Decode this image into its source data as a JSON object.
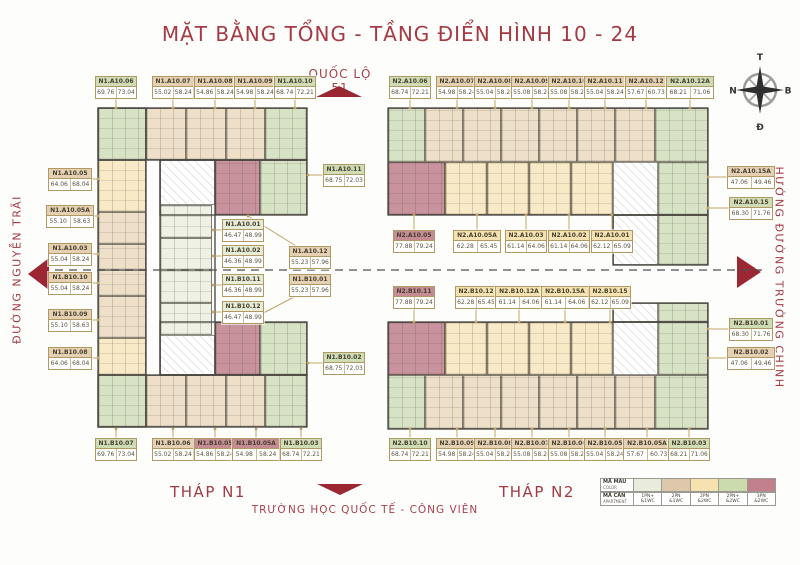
{
  "title": "MẶT BẰNG TỔNG - TẦNG ĐIỂN HÌNH 10 - 24",
  "roads": {
    "top": "QUỐC LỘ 51",
    "left": "ĐƯỜNG NGUYỄN TRÃI",
    "right": "HƯỚNG ĐƯỜNG TRƯỜNG CHINH",
    "bottom": "TRƯỜNG HỌC QUỐC TẾ - CÔNG VIÊN"
  },
  "towers": {
    "n1": "THÁP N1",
    "n2": "THÁP N2"
  },
  "compass": {
    "top": "T",
    "left": "N",
    "right": "B",
    "bottom": "Đ"
  },
  "legend": {
    "row1_label": "MÃ MÀU",
    "row1_sub": "COLOR",
    "row2_label": "MÃ CĂN",
    "row2_sub": "APARTMENT",
    "types": [
      {
        "code": "1PN+",
        "wc": "&1WC",
        "color": "#e9ecdc",
        "key": "celadon"
      },
      {
        "code": "2PN",
        "wc": "&1WC",
        "color": "#ddc8ab",
        "key": "tan"
      },
      {
        "code": "2PN",
        "wc": "&2WC",
        "color": "#f6e2ae",
        "key": "yellow"
      },
      {
        "code": "2PN+",
        "wc": "&2WC",
        "color": "#cbdbae",
        "key": "green"
      },
      {
        "code": "3PN",
        "wc": "&2WC",
        "color": "#c2808d",
        "key": "pink"
      }
    ]
  },
  "accent_red": "#a43a44",
  "arrow_red": "#9b2733",
  "units": [
    {
      "name": "N1.A10.06",
      "a1": "69.76",
      "a2": "73.04",
      "type": "green",
      "x": 95,
      "y": 76,
      "dir": "down"
    },
    {
      "name": "N1.A10.07",
      "a1": "55.02",
      "a2": "58.24",
      "type": "tan",
      "x": 152,
      "y": 76,
      "dir": "down"
    },
    {
      "name": "N1.A10.08",
      "a1": "54.86",
      "a2": "58.24",
      "type": "tan",
      "x": 194,
      "y": 76,
      "dir": "down"
    },
    {
      "name": "N1.A10.09",
      "a1": "54.98",
      "a2": "58.24",
      "type": "tan",
      "x": 234,
      "y": 76,
      "dir": "down"
    },
    {
      "name": "N1.A10.10",
      "a1": "68.74",
      "a2": "72.21",
      "type": "green",
      "x": 274,
      "y": 76,
      "dir": "down"
    },
    {
      "name": "N2.A10.06",
      "a1": "68.74",
      "a2": "72.21",
      "type": "green",
      "x": 389,
      "y": 76,
      "dir": "down"
    },
    {
      "name": "N2.A10.07",
      "a1": "54.98",
      "a2": "58.24",
      "type": "tan",
      "x": 436,
      "y": 76,
      "dir": "down"
    },
    {
      "name": "N2.A10.08",
      "a1": "55.04",
      "a2": "58.24",
      "type": "tan",
      "x": 474,
      "y": 76,
      "dir": "down"
    },
    {
      "name": "N2.A10.09",
      "a1": "55.08",
      "a2": "58.24",
      "type": "tan",
      "x": 511,
      "y": 76,
      "dir": "down"
    },
    {
      "name": "N2.A10.10",
      "a1": "55.08",
      "a2": "58.24",
      "type": "tan",
      "x": 548,
      "y": 76,
      "dir": "down"
    },
    {
      "name": "N2.A10.11",
      "a1": "55.04",
      "a2": "58.24",
      "type": "tan",
      "x": 584,
      "y": 76,
      "dir": "down"
    },
    {
      "name": "N2.A10.12",
      "a1": "57.67",
      "a2": "60.73",
      "type": "tan",
      "x": 625,
      "y": 76,
      "dir": "down"
    },
    {
      "name": "N2.A10.12A",
      "a1": "68.21",
      "a2": "71.06",
      "type": "green",
      "x": 666,
      "y": 76,
      "w": 48,
      "dir": "down"
    },
    {
      "name": "N1.A10.05",
      "a1": "64.06",
      "a2": "68.04",
      "type": "tan",
      "x": 48,
      "y": 168,
      "w": 44,
      "dir": "right"
    },
    {
      "name": "N1.A10.05A",
      "a1": "55.10",
      "a2": "58.63",
      "type": "tan",
      "x": 46,
      "y": 205,
      "w": 48,
      "dir": "right"
    },
    {
      "name": "N1.A10.03",
      "a1": "55.04",
      "a2": "58.24",
      "type": "tan",
      "x": 48,
      "y": 243,
      "w": 44,
      "dir": "right"
    },
    {
      "name": "N1.B10.10",
      "a1": "55.04",
      "a2": "58.24",
      "type": "tan",
      "x": 48,
      "y": 272,
      "w": 44,
      "dir": "right"
    },
    {
      "name": "N1.B10.09",
      "a1": "55.10",
      "a2": "58.63",
      "type": "tan",
      "x": 48,
      "y": 309,
      "w": 44,
      "dir": "right"
    },
    {
      "name": "N1.B10.08",
      "a1": "64.06",
      "a2": "68.04",
      "type": "tan",
      "x": 48,
      "y": 347,
      "w": 44,
      "dir": "right"
    },
    {
      "name": "N1.A10.11",
      "a1": "68.75",
      "a2": "72.03",
      "type": "green",
      "x": 323,
      "y": 164,
      "leader": [
        323,
        175,
        308,
        175
      ]
    },
    {
      "name": "N1.A10.01",
      "a1": "46.47",
      "a2": "48.99",
      "type": "celadon",
      "x": 222,
      "y": 219,
      "leader": [
        222,
        230,
        213,
        230
      ]
    },
    {
      "name": "N1.A10.02",
      "a1": "46.36",
      "a2": "48.99",
      "type": "celadon",
      "x": 222,
      "y": 245,
      "leader": [
        222,
        256,
        213,
        256
      ]
    },
    {
      "name": "N1.A10.12",
      "a1": "55.23",
      "a2": "57.96",
      "type": "tan",
      "x": 289,
      "y": 246,
      "leader": [
        296,
        246,
        248,
        216
      ]
    },
    {
      "name": "N1.B10.11",
      "a1": "46.36",
      "a2": "48.99",
      "type": "celadon",
      "x": 222,
      "y": 274,
      "leader": [
        222,
        285,
        213,
        285
      ]
    },
    {
      "name": "N1.B10.01",
      "a1": "55.23",
      "a2": "57.96",
      "type": "tan",
      "x": 289,
      "y": 274,
      "leader": [
        296,
        296,
        248,
        321
      ]
    },
    {
      "name": "N1.B10.12",
      "a1": "46.47",
      "a2": "48.99",
      "type": "celadon",
      "x": 222,
      "y": 301,
      "leader": [
        222,
        312,
        213,
        312
      ]
    },
    {
      "name": "N1.B10.02",
      "a1": "68.75",
      "a2": "72.03",
      "type": "green",
      "x": 323,
      "y": 352,
      "leader": [
        323,
        363,
        308,
        363
      ]
    },
    {
      "name": "N2.A10.05",
      "a1": "77.88",
      "a2": "79.24",
      "type": "pink",
      "x": 393,
      "y": 230,
      "dir": "up-short"
    },
    {
      "name": "N2.A10.05A",
      "a1": "62.28",
      "a2": "65.45",
      "type": "yellow",
      "x": 453,
      "y": 230,
      "w": 48,
      "dir": "up-short"
    },
    {
      "name": "N2.A10.03",
      "a1": "61.14",
      "a2": "64.06",
      "type": "yellow",
      "x": 505,
      "y": 230,
      "dir": "up-short"
    },
    {
      "name": "N2.A10.02",
      "a1": "61.14",
      "a2": "64.06",
      "type": "yellow",
      "x": 548,
      "y": 230,
      "dir": "up-short"
    },
    {
      "name": "N2.A10.01",
      "a1": "62.12",
      "a2": "65.09",
      "type": "yellow",
      "x": 591,
      "y": 230,
      "dir": "up-short"
    },
    {
      "name": "N2.B10.11",
      "a1": "77.88",
      "a2": "79.24",
      "type": "pink",
      "x": 393,
      "y": 286,
      "dir": "down-short"
    },
    {
      "name": "N2.B10.12",
      "a1": "62.28",
      "a2": "65.45",
      "type": "yellow",
      "x": 455,
      "y": 286,
      "dir": "down-short"
    },
    {
      "name": "N2.B10.12A",
      "a1": "61.14",
      "a2": "64.06",
      "type": "yellow",
      "x": 495,
      "y": 286,
      "w": 48,
      "dir": "down-short"
    },
    {
      "name": "N2.B10.15A",
      "a1": "61.14",
      "a2": "64.06",
      "type": "yellow",
      "x": 541,
      "y": 286,
      "w": 48,
      "dir": "down-short"
    },
    {
      "name": "N2.B10.15",
      "a1": "62.12",
      "a2": "65.09",
      "type": "yellow",
      "x": 589,
      "y": 286,
      "dir": "down-short"
    },
    {
      "name": "N2.A10.15A",
      "a1": "47.06",
      "a2": "49.46",
      "type": "tan",
      "x": 727,
      "y": 166,
      "w": 48,
      "dir": "left"
    },
    {
      "name": "N2.A10.15",
      "a1": "68.30",
      "a2": "71.76",
      "type": "green",
      "x": 729,
      "y": 197,
      "w": 44,
      "dir": "left"
    },
    {
      "name": "N2.B10.01",
      "a1": "68.30",
      "a2": "71.76",
      "type": "green",
      "x": 729,
      "y": 318,
      "w": 44,
      "dir": "left"
    },
    {
      "name": "N2.B10.02",
      "a1": "47.06",
      "a2": "49.46",
      "type": "tan",
      "x": 727,
      "y": 347,
      "w": 48,
      "dir": "left"
    },
    {
      "name": "N1.B10.07",
      "a1": "69.76",
      "a2": "73.04",
      "type": "green",
      "x": 95,
      "y": 438,
      "dir": "up"
    },
    {
      "name": "N1.B10.06",
      "a1": "55.02",
      "a2": "58.24",
      "type": "tan",
      "x": 152,
      "y": 438,
      "dir": "up"
    },
    {
      "name": "N1.B10.05",
      "a1": "54.86",
      "a2": "58.24",
      "type": "pink",
      "x": 194,
      "y": 438,
      "dir": "up"
    },
    {
      "name": "N1.B10.05A",
      "a1": "54.98",
      "a2": "58.24",
      "type": "pink",
      "x": 232,
      "y": 438,
      "w": 48,
      "dir": "up"
    },
    {
      "name": "N1.B10.03",
      "a1": "68.74",
      "a2": "72.21",
      "type": "green",
      "x": 280,
      "y": 438,
      "dir": "up"
    },
    {
      "name": "N2.B10.10",
      "a1": "68.74",
      "a2": "72.21",
      "type": "green",
      "x": 389,
      "y": 438,
      "dir": "up"
    },
    {
      "name": "N2.B10.09",
      "a1": "54.98",
      "a2": "58.24",
      "type": "tan",
      "x": 436,
      "y": 438,
      "dir": "up"
    },
    {
      "name": "N2.B10.08",
      "a1": "55.04",
      "a2": "58.24",
      "type": "tan",
      "x": 474,
      "y": 438,
      "dir": "up"
    },
    {
      "name": "N2.B10.07",
      "a1": "55.08",
      "a2": "58.24",
      "type": "tan",
      "x": 511,
      "y": 438,
      "dir": "up"
    },
    {
      "name": "N2.B10.06",
      "a1": "55.08",
      "a2": "58.24",
      "type": "tan",
      "x": 548,
      "y": 438,
      "dir": "up"
    },
    {
      "name": "N2.B10.05",
      "a1": "55.04",
      "a2": "58.24",
      "type": "tan",
      "x": 584,
      "y": 438,
      "dir": "up"
    },
    {
      "name": "N2.B10.05A",
      "a1": "57.67",
      "a2": "60.73",
      "type": "tan",
      "x": 623,
      "y": 438,
      "w": 48,
      "dir": "up"
    },
    {
      "name": "N2.B10.03",
      "a1": "68.21",
      "a2": "71.06",
      "type": "green",
      "x": 668,
      "y": 438,
      "dir": "up"
    }
  ],
  "floorplan": {
    "zones": [
      {
        "t": "green",
        "box": [
          98,
          108,
          48,
          52
        ]
      },
      {
        "t": "tan",
        "box": [
          146,
          108,
          40,
          52
        ]
      },
      {
        "t": "tan",
        "box": [
          186,
          108,
          40,
          52
        ]
      },
      {
        "t": "tan",
        "box": [
          226,
          108,
          39,
          52
        ]
      },
      {
        "t": "green",
        "box": [
          265,
          108,
          42,
          52
        ]
      },
      {
        "t": "yellow",
        "box": [
          98,
          160,
          48,
          52
        ]
      },
      {
        "t": "tan",
        "box": [
          98,
          212,
          48,
          32
        ]
      },
      {
        "t": "tan",
        "box": [
          98,
          244,
          48,
          26
        ]
      },
      {
        "t": "tan",
        "box": [
          98,
          270,
          48,
          26
        ]
      },
      {
        "t": "tan",
        "box": [
          98,
          296,
          48,
          42
        ]
      },
      {
        "t": "yellow",
        "box": [
          98,
          338,
          48,
          37
        ]
      },
      {
        "t": "green",
        "box": [
          98,
          375,
          48,
          52
        ]
      },
      {
        "t": "tan",
        "box": [
          146,
          375,
          40,
          52
        ]
      },
      {
        "t": "tan",
        "box": [
          186,
          375,
          40,
          52
        ]
      },
      {
        "t": "tan",
        "box": [
          226,
          375,
          39,
          52
        ]
      },
      {
        "t": "green",
        "box": [
          265,
          375,
          42,
          52
        ]
      },
      {
        "t": "core",
        "box": [
          160,
          160,
          55,
          45
        ]
      },
      {
        "t": "celadon",
        "box": [
          160,
          205,
          52,
          33
        ]
      },
      {
        "t": "celadon",
        "box": [
          160,
          238,
          52,
          32
        ]
      },
      {
        "t": "celadon",
        "box": [
          160,
          270,
          52,
          33
        ]
      },
      {
        "t": "celadon",
        "box": [
          160,
          303,
          52,
          32
        ]
      },
      {
        "t": "core",
        "box": [
          160,
          335,
          55,
          40
        ]
      },
      {
        "t": "pink",
        "box": [
          215,
          160,
          45,
          55
        ]
      },
      {
        "t": "green",
        "box": [
          260,
          160,
          47,
          55
        ]
      },
      {
        "t": "pink",
        "box": [
          215,
          322,
          45,
          53
        ]
      },
      {
        "t": "green",
        "box": [
          260,
          322,
          47,
          53
        ]
      },
      {
        "t": "green",
        "box": [
          388,
          108,
          37,
          54
        ]
      },
      {
        "t": "tan",
        "box": [
          425,
          108,
          38,
          54
        ]
      },
      {
        "t": "tan",
        "box": [
          463,
          108,
          38,
          54
        ]
      },
      {
        "t": "tan",
        "box": [
          501,
          108,
          38,
          54
        ]
      },
      {
        "t": "tan",
        "box": [
          539,
          108,
          38,
          54
        ]
      },
      {
        "t": "tan",
        "box": [
          577,
          108,
          38,
          54
        ]
      },
      {
        "t": "tan",
        "box": [
          615,
          108,
          40,
          54
        ]
      },
      {
        "t": "green",
        "box": [
          655,
          108,
          53,
          54
        ]
      },
      {
        "t": "pink",
        "box": [
          388,
          162,
          57,
          53
        ]
      },
      {
        "t": "yellow",
        "box": [
          445,
          162,
          42,
          53
        ]
      },
      {
        "t": "yellow",
        "box": [
          487,
          162,
          42,
          53
        ]
      },
      {
        "t": "yellow",
        "box": [
          529,
          162,
          42,
          53
        ]
      },
      {
        "t": "yellow",
        "box": [
          571,
          162,
          42,
          53
        ]
      },
      {
        "t": "core",
        "box": [
          613,
          162,
          45,
          53
        ]
      },
      {
        "t": "green",
        "box": [
          658,
          162,
          50,
          53
        ]
      },
      {
        "t": "core",
        "box": [
          613,
          215,
          45,
          50
        ]
      },
      {
        "t": "green",
        "box": [
          658,
          215,
          50,
          50
        ]
      },
      {
        "t": "core",
        "box": [
          613,
          303,
          45,
          19
        ]
      },
      {
        "t": "green",
        "box": [
          658,
          303,
          50,
          19
        ]
      },
      {
        "t": "pink",
        "box": [
          388,
          322,
          57,
          53
        ]
      },
      {
        "t": "yellow",
        "box": [
          445,
          322,
          42,
          53
        ]
      },
      {
        "t": "yellow",
        "box": [
          487,
          322,
          42,
          53
        ]
      },
      {
        "t": "yellow",
        "box": [
          529,
          322,
          42,
          53
        ]
      },
      {
        "t": "yellow",
        "box": [
          571,
          322,
          42,
          53
        ]
      },
      {
        "t": "core",
        "box": [
          613,
          322,
          45,
          53
        ]
      },
      {
        "t": "green",
        "box": [
          658,
          322,
          50,
          53
        ]
      },
      {
        "t": "green",
        "box": [
          388,
          375,
          37,
          54
        ]
      },
      {
        "t": "tan",
        "box": [
          425,
          375,
          38,
          54
        ]
      },
      {
        "t": "tan",
        "box": [
          463,
          375,
          38,
          54
        ]
      },
      {
        "t": "tan",
        "box": [
          501,
          375,
          38,
          54
        ]
      },
      {
        "t": "tan",
        "box": [
          539,
          375,
          38,
          54
        ]
      },
      {
        "t": "tan",
        "box": [
          577,
          375,
          38,
          54
        ]
      },
      {
        "t": "tan",
        "box": [
          615,
          375,
          40,
          54
        ]
      },
      {
        "t": "green",
        "box": [
          655,
          375,
          53,
          54
        ]
      }
    ],
    "outlines": [
      [
        98,
        108,
        209,
        52
      ],
      [
        98,
        375,
        209,
        52
      ],
      [
        98,
        108,
        48,
        319
      ],
      [
        160,
        160,
        147,
        55
      ],
      [
        160,
        322,
        147,
        53
      ],
      [
        160,
        160,
        55,
        215
      ],
      [
        388,
        108,
        320,
        107
      ],
      [
        613,
        215,
        95,
        50
      ],
      [
        388,
        322,
        320,
        107
      ],
      [
        613,
        303,
        95,
        19
      ]
    ],
    "dashline_y": 270
  }
}
